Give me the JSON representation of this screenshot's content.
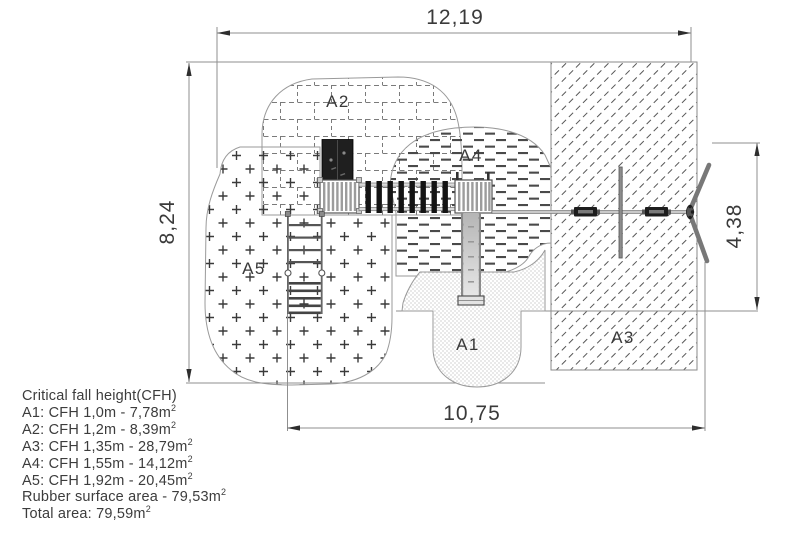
{
  "drawing": {
    "type": "playground-safety-area-plan",
    "dimensions": {
      "width_top": "12,19",
      "height_left": "8,24",
      "height_right": "4,38",
      "width_bottom": "10,75"
    },
    "areas": {
      "a1": "A1",
      "a2": "A2",
      "a3": "A3",
      "a4": "A4",
      "a5": "A5"
    },
    "colors": {
      "line": "#909090",
      "text": "#3a3a3a",
      "equipment_dark": "#1f1f1f",
      "background": "#ffffff"
    }
  },
  "legend": {
    "title": "Critical fall height(CFH)",
    "entries": [
      {
        "text": "A1: CFH 1,0m - 7,78m",
        "sup": "2"
      },
      {
        "text": "A2: CFH 1,2m - 8,39m",
        "sup": "2"
      },
      {
        "text": "A3: CFH 1,35m - 28,79m",
        "sup": "2"
      },
      {
        "text": "A4: CFH 1,55m - 14,12m",
        "sup": "2"
      },
      {
        "text": "A5: CFH 1,92m - 20,45m",
        "sup": "2"
      },
      {
        "text": "Rubber surface area - 79,53m",
        "sup": "2"
      },
      {
        "text": "Total area: 79,59m",
        "sup": "2"
      }
    ]
  }
}
